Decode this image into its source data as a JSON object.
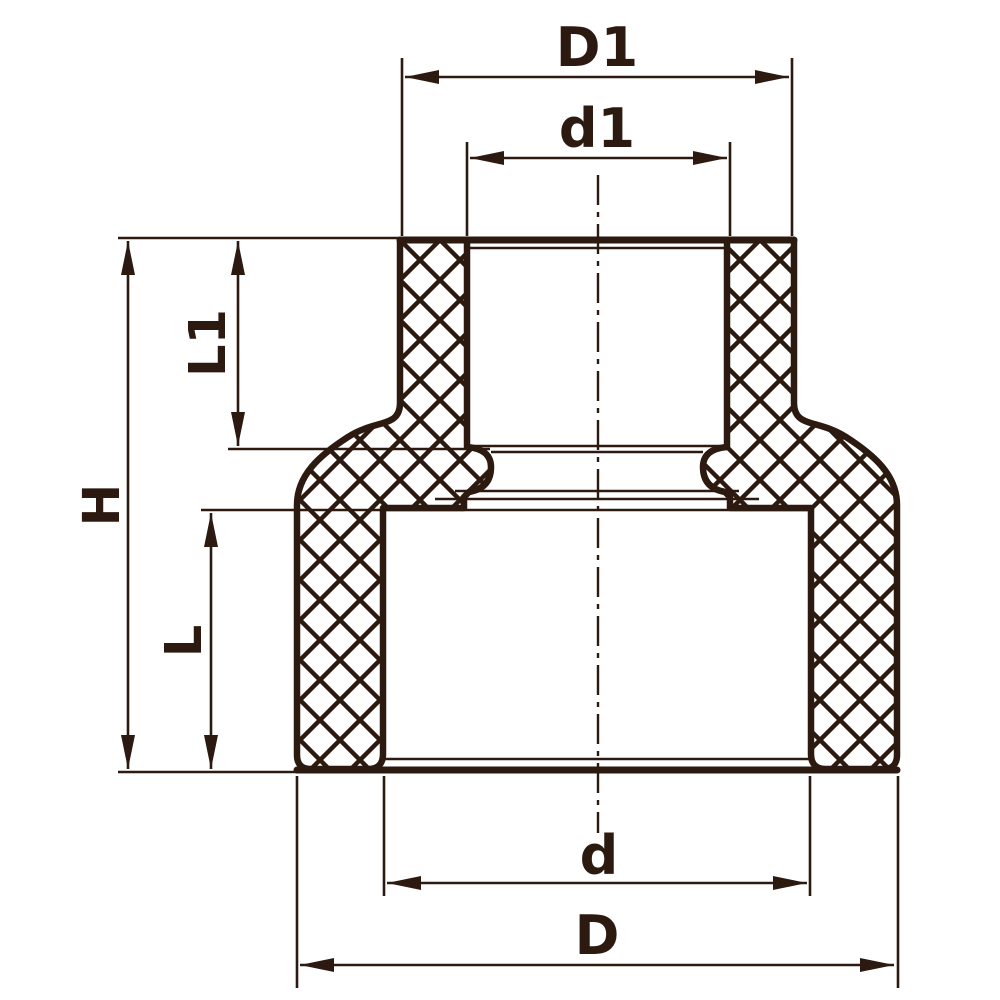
{
  "drawing": {
    "background_color": "#ffffff",
    "line_color": "#2c1a10",
    "labels": {
      "top_outer_diameter": "D1",
      "top_inner_diameter": "d1",
      "top_socket_depth": "L1",
      "overall_height": "H",
      "bottom_socket_depth": "L",
      "bottom_inner_diameter": "d",
      "bottom_outer_diameter": "D"
    }
  }
}
